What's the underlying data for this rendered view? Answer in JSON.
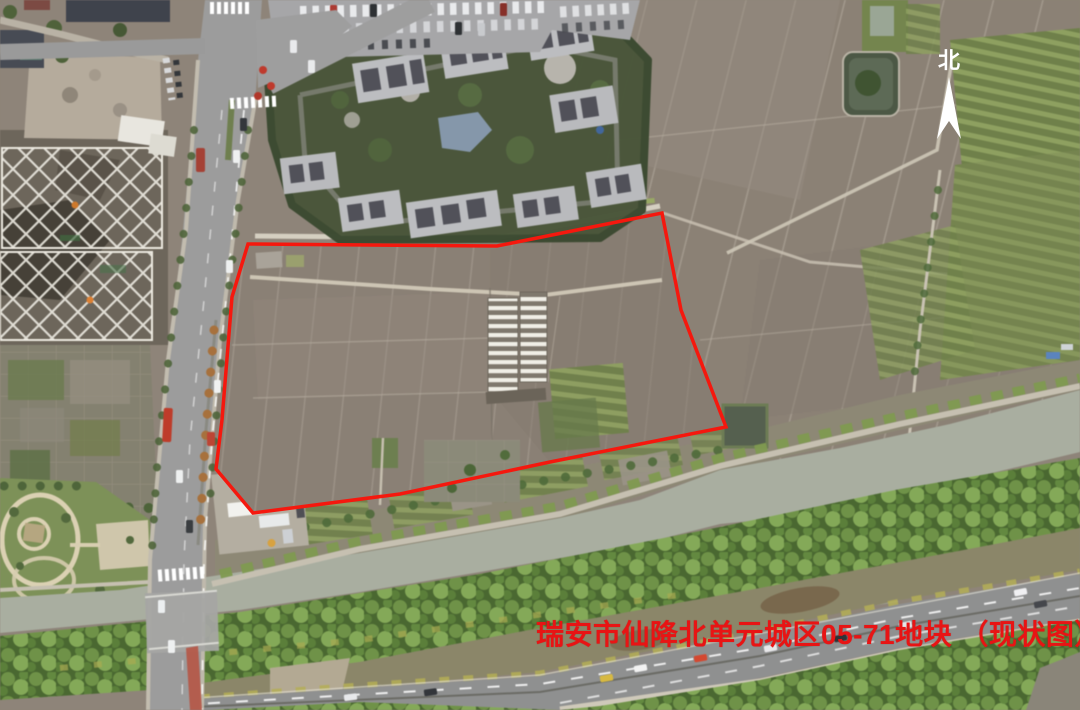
{
  "map": {
    "title": "瑞安市仙降北单元城区05-71地块 （现状图）",
    "compass": {
      "label": "北"
    },
    "colors": {
      "parcel_outline": "#f5180e",
      "title_text": "#e81414"
    }
  }
}
